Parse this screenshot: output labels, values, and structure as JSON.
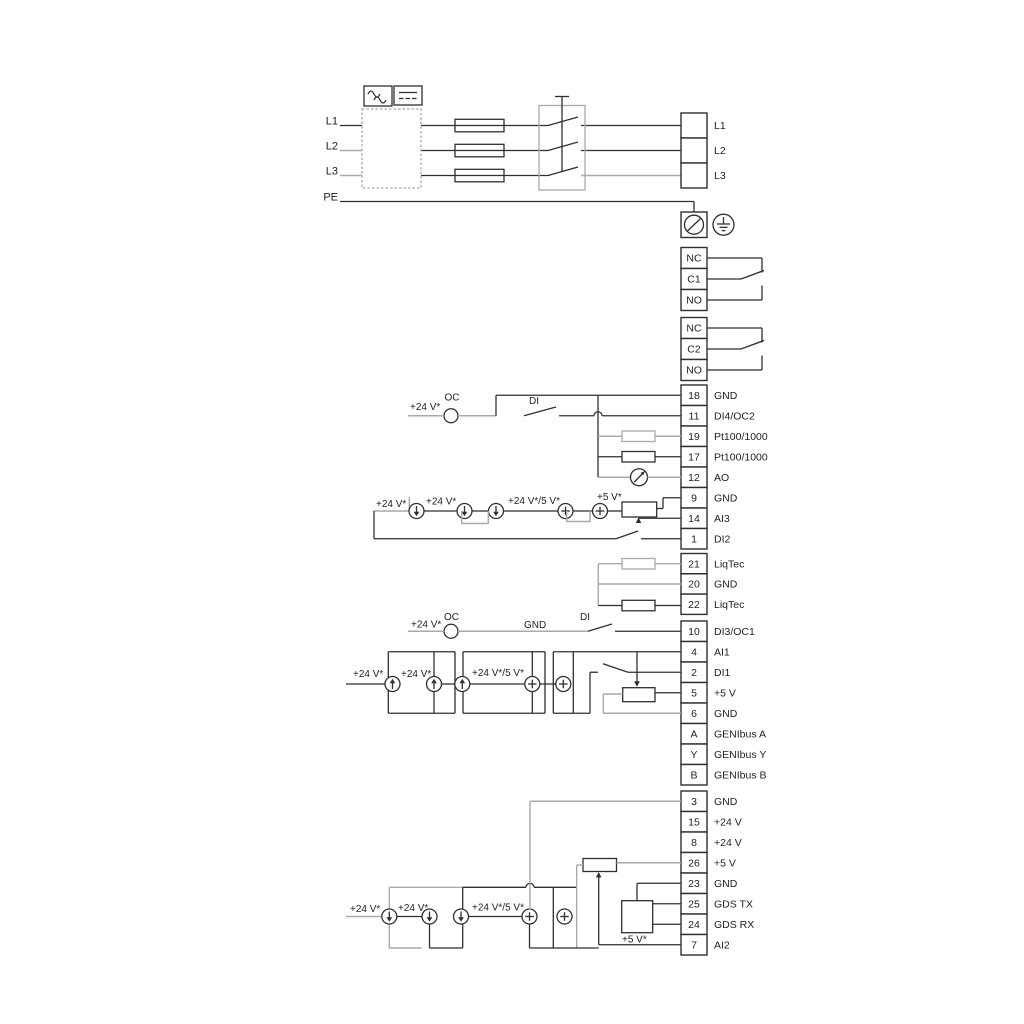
{
  "colors": {
    "wire": "#2f2f2f",
    "wire_alt": "#a9a9a9",
    "text": "#1f1f1f",
    "background": "#ffffff"
  },
  "mains": {
    "inputs": [
      "L1",
      "L2",
      "L3"
    ],
    "pe": "PE",
    "outputs": [
      "L1",
      "L2",
      "L3"
    ]
  },
  "relays": [
    {
      "rows": [
        "NC",
        "C1",
        "NO"
      ]
    },
    {
      "rows": [
        "NC",
        "C2",
        "NO"
      ]
    }
  ],
  "block_a": {
    "rows": [
      {
        "n": "18",
        "label": "GND"
      },
      {
        "n": "11",
        "label": "DI4/OC2"
      },
      {
        "n": "19",
        "label": "Pt100/1000"
      },
      {
        "n": "17",
        "label": "Pt100/1000"
      },
      {
        "n": "12",
        "label": "AO"
      },
      {
        "n": "9",
        "label": "GND"
      },
      {
        "n": "14",
        "label": "AI3"
      },
      {
        "n": "1",
        "label": "DI2"
      }
    ]
  },
  "liqtec": {
    "rows": [
      {
        "n": "21",
        "label": "LiqTec"
      },
      {
        "n": "20",
        "label": "GND"
      },
      {
        "n": "22",
        "label": "LiqTec"
      }
    ]
  },
  "block_b": {
    "rows": [
      {
        "n": "10",
        "label": "DI3/OC1"
      },
      {
        "n": "4",
        "label": "AI1"
      },
      {
        "n": "2",
        "label": "DI1"
      },
      {
        "n": "5",
        "label": "+5 V"
      },
      {
        "n": "6",
        "label": "GND"
      },
      {
        "n": "A",
        "label": "GENIbus A"
      },
      {
        "n": "Y",
        "label": "GENIbus Y"
      },
      {
        "n": "B",
        "label": "GENIbus B"
      }
    ]
  },
  "block_c": {
    "rows": [
      {
        "n": "3",
        "label": "GND"
      },
      {
        "n": "15",
        "label": "+24 V"
      },
      {
        "n": "8",
        "label": "+24 V"
      },
      {
        "n": "26",
        "label": "+5 V"
      },
      {
        "n": "23",
        "label": "GND"
      },
      {
        "n": "25",
        "label": "GDS TX"
      },
      {
        "n": "24",
        "label": "GDS RX"
      },
      {
        "n": "7",
        "label": "AI2"
      }
    ]
  },
  "section_a": {
    "supply": "+24 V*",
    "oc": "OC",
    "di": "DI",
    "sources": [
      "+24 V*",
      "+24 V*",
      "+24 V*/5 V*",
      "+5 V*"
    ]
  },
  "section_b": {
    "supply": "+24 V*",
    "oc": "OC",
    "gnd": "GND",
    "di": "DI",
    "sources": [
      "+24 V*",
      "+24 V*",
      "+24 V*/5 V*"
    ]
  },
  "section_c": {
    "sources": [
      "+24 V*",
      "+24 V*",
      "+24 V*/5 V*"
    ],
    "gds_supply": "+5 V*"
  }
}
